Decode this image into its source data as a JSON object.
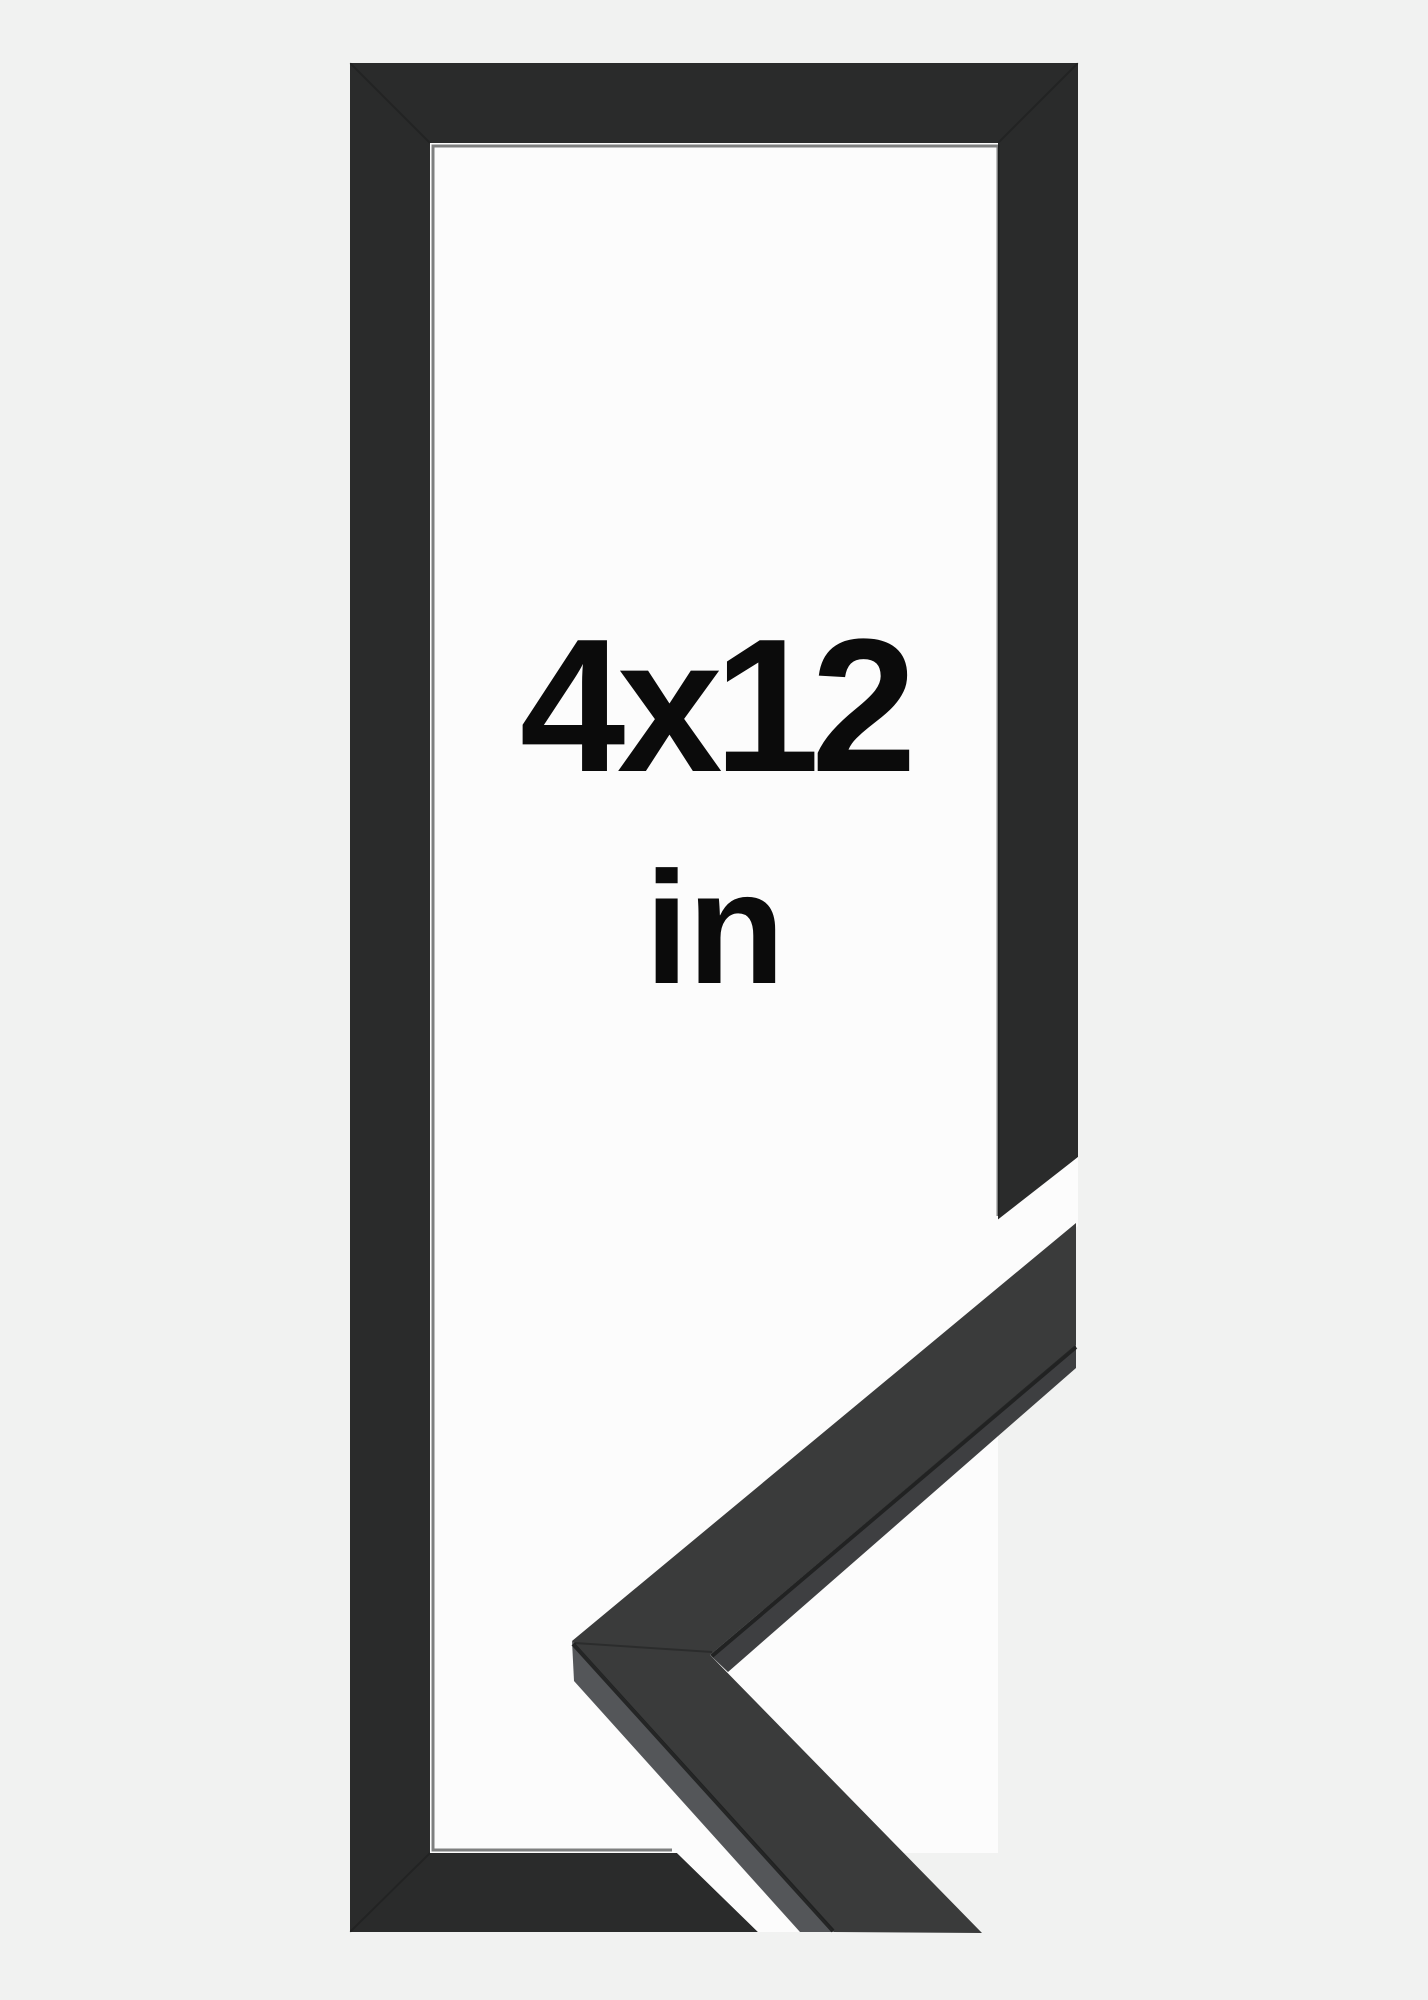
{
  "product_image": {
    "description": "Empty black picture frame shown upright with a mitered moulding corner sample overlapping the cut-away bottom-right corner",
    "size_label": "4x12",
    "unit_label": "in"
  },
  "colors": {
    "bg": "#f1f2f1",
    "photo-white": "#fcfcfc",
    "frame-black": "#2a2b2b",
    "frame-edge": "#161717",
    "sample-top": "#3a3b3b",
    "sample-side-light": "#545659",
    "sample-side-dark": "#3e3f41",
    "seam": "#1c1d1d",
    "text": "#0b0b0b"
  }
}
